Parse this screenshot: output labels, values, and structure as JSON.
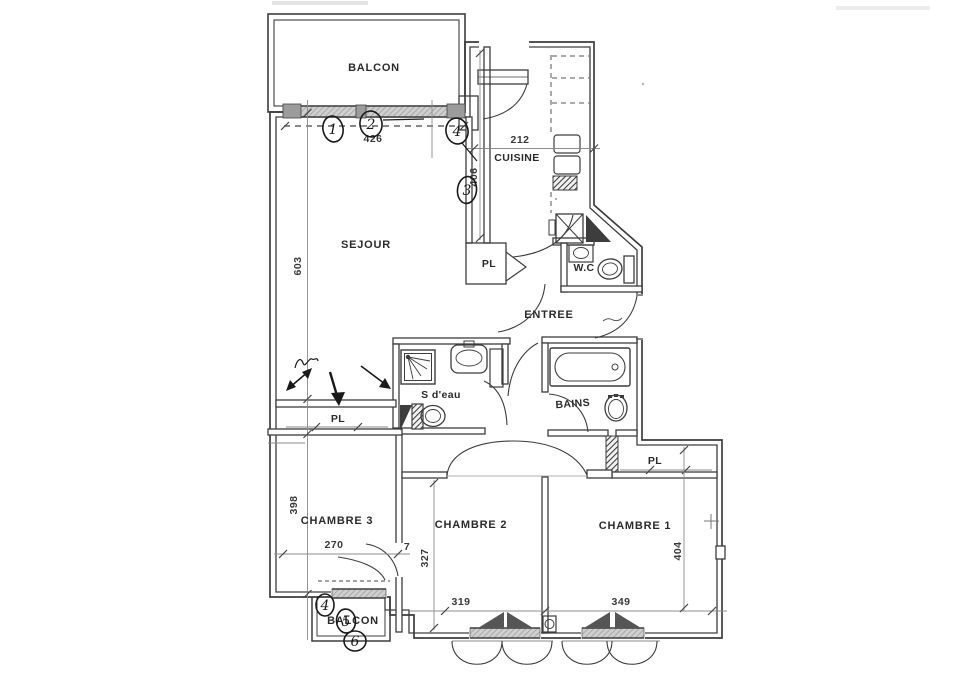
{
  "canvas": {
    "background": "#ffffff",
    "ink": "#3d3d3d",
    "construction": "#8c8c8c",
    "handwriting": "#1a1a1a"
  },
  "rooms": {
    "balcon_top": {
      "label": "BALCON"
    },
    "cuisine": {
      "label": "CUISINE"
    },
    "sejour": {
      "label": "SEJOUR"
    },
    "wc": {
      "label": "W.C"
    },
    "entree": {
      "label": "ENTREE"
    },
    "pl_entree": {
      "label": "PL"
    },
    "s_deau": {
      "label": "S d'eau"
    },
    "bains": {
      "label": "BAINS"
    },
    "pl_sejour": {
      "label": "PL"
    },
    "pl_chambre1": {
      "label": "PL"
    },
    "chambre1": {
      "label": "CHAMBRE 1"
    },
    "chambre2": {
      "label": "CHAMBRE 2"
    },
    "chambre3": {
      "label": "CHAMBRE 3"
    },
    "balcon_bottom": {
      "label": "BALCON"
    }
  },
  "dimensions": {
    "sejour_width": "426",
    "cuisine_width": "212",
    "cuisine_depth": "406",
    "sejour_depth": "603",
    "chambre3_depth": "398",
    "chambre3_width": "270",
    "chambre3_width_extra": "7",
    "chambre2_depth": "327",
    "chambre2_width": "319",
    "chambre1_width": "349",
    "chambre1_depth": "404"
  },
  "handwritten_marks": {
    "window_mark_1": "1",
    "window_mark_2": "2",
    "window_mark_3": "4",
    "kitchen_mark": "3",
    "balcony_mark_1": "4",
    "balcony_mark_2": "5",
    "balcony_mark_3": "6"
  }
}
